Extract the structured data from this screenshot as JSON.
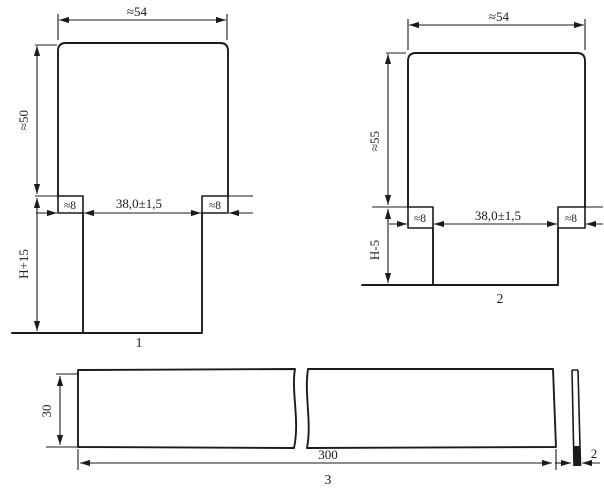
{
  "colors": {
    "ink": "#1b1b1b",
    "paper": "#ffffff"
  },
  "parts": [
    {
      "label": "1",
      "width": "≈54",
      "height": "≈50",
      "tab_left": "≈8",
      "tab_right": "≈8",
      "slot_width": "38,0±1,5",
      "leg_length": "H+15"
    },
    {
      "label": "2",
      "width": "≈54",
      "height": "≈55",
      "tab_left": "≈8",
      "tab_right": "≈8",
      "slot_width": "38,0±1,5",
      "leg_length": "H-5"
    },
    {
      "label": "3",
      "height": "30",
      "length": "300",
      "thickness": "2"
    }
  ]
}
